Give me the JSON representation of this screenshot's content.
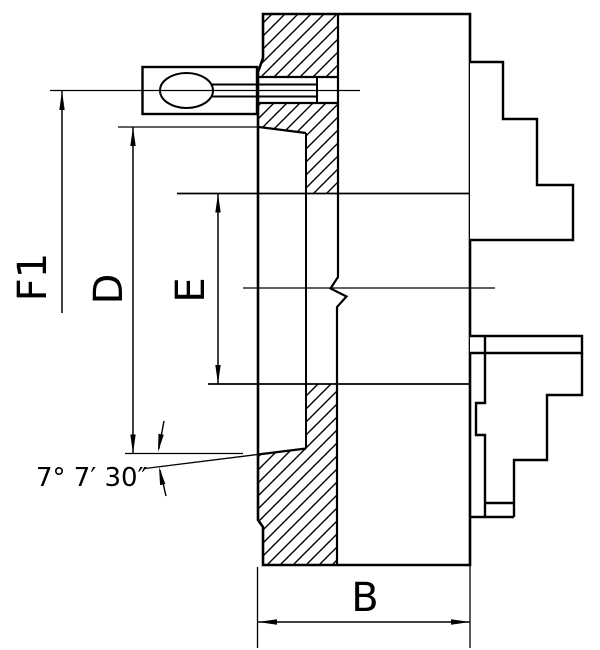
{
  "drawing": {
    "labels": {
      "f1": "F1",
      "d": "D",
      "e": "E",
      "b": "B",
      "angle": "7° 7′ 30″"
    },
    "colors": {
      "line": "#000000",
      "background": "#ffffff"
    }
  }
}
